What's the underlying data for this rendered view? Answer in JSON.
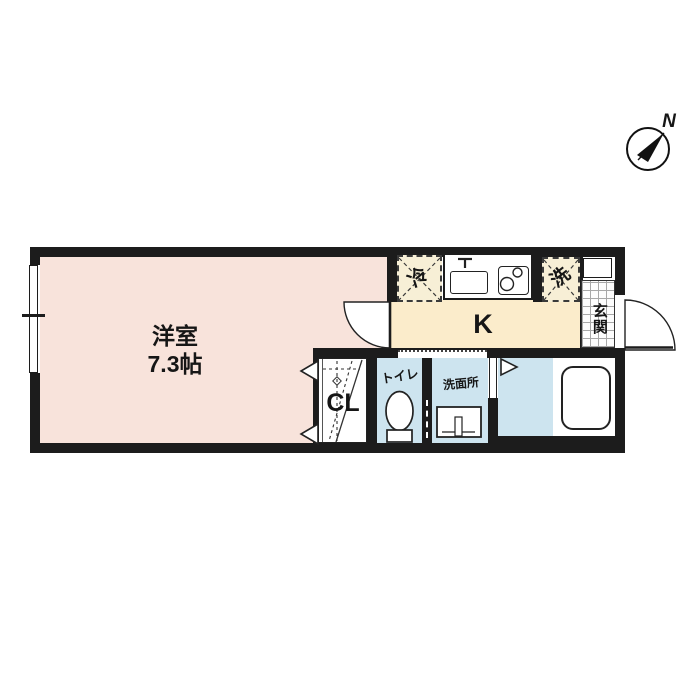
{
  "compass": {
    "label": "N"
  },
  "rooms": {
    "western_room": {
      "name": "洋室",
      "area": "7.3帖"
    },
    "kitchen": {
      "label": "K"
    },
    "refrigerator": {
      "label": "冷"
    },
    "washer": {
      "label": "洗"
    },
    "entrance": {
      "label": "玄関"
    },
    "toilet": {
      "label": "トイレ"
    },
    "washroom": {
      "label": "洗面所"
    },
    "closet": {
      "label": "CL"
    }
  },
  "colors": {
    "wall": "#1c1c1c",
    "western_room": "#f8e3db",
    "kitchen": "#fbeccb",
    "appliance_box": "#f7efd6",
    "wet_area": "#cde4ef",
    "background": "#ffffff"
  }
}
